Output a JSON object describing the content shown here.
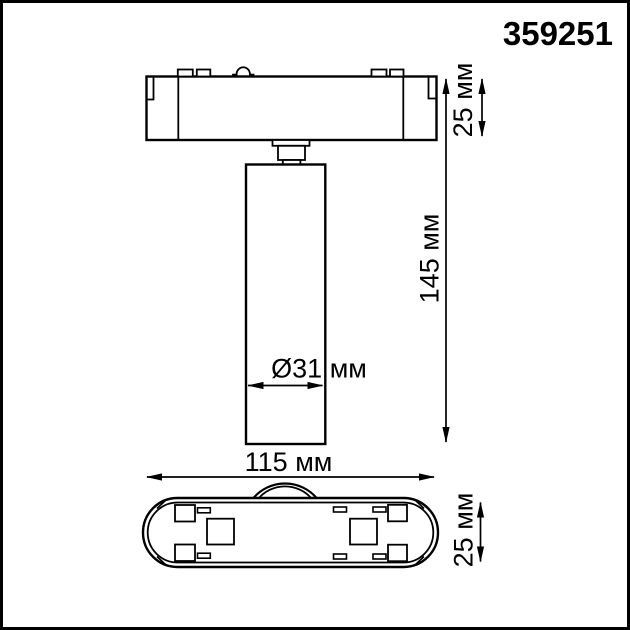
{
  "product_code": "359251",
  "colors": {
    "line": "#000000",
    "background": "#ffffff"
  },
  "dimensions": {
    "base_height": "25 мм",
    "overall_height": "145 мм",
    "spot_diameter": "Ø31 мм",
    "base_width": "115 мм",
    "base_depth": "25 мм"
  }
}
